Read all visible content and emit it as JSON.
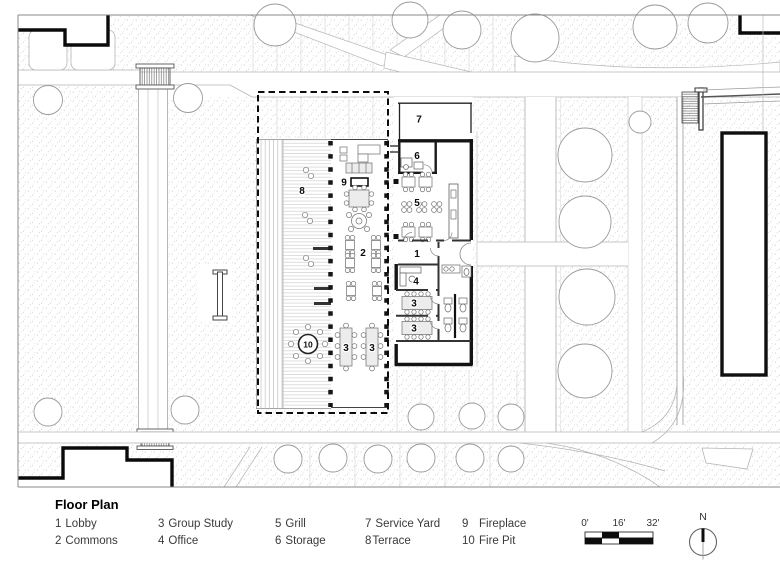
{
  "page": {
    "title": "Floor Plan"
  },
  "legend": {
    "title": "Floor Plan",
    "entries": [
      {
        "num": "1",
        "label": "Lobby"
      },
      {
        "num": "2",
        "label": "Commons"
      },
      {
        "num": "3",
        "label": "Group Study"
      },
      {
        "num": "4",
        "label": "Office"
      },
      {
        "num": "5",
        "label": "Grill"
      },
      {
        "num": "6",
        "label": "Storage"
      },
      {
        "num": "7",
        "label": "Service Yard"
      },
      {
        "num": "8",
        "label": "Terrace"
      },
      {
        "num": "9",
        "label": "Fireplace"
      },
      {
        "num": "10",
        "label": "Fire Pit"
      }
    ]
  },
  "plan": {
    "room_labels": {
      "lobby": "1",
      "commons": "2",
      "group_study": "3",
      "office": "4",
      "grill": "5",
      "storage": "6",
      "service_yard": "7",
      "terrace": "8",
      "fireplace": "9",
      "fire_pit": "10"
    }
  },
  "scale_bar": {
    "labels": [
      "0'",
      "16'",
      "32'"
    ]
  },
  "north_arrow": {
    "label": "N"
  },
  "colors": {
    "wall": "#1a1a1a",
    "boundary_dash": "#0c0c0c",
    "legend_text": "#3a3a3a",
    "stipple_dot": "#bfbfbf",
    "path_edge": "#b5b5b5"
  }
}
